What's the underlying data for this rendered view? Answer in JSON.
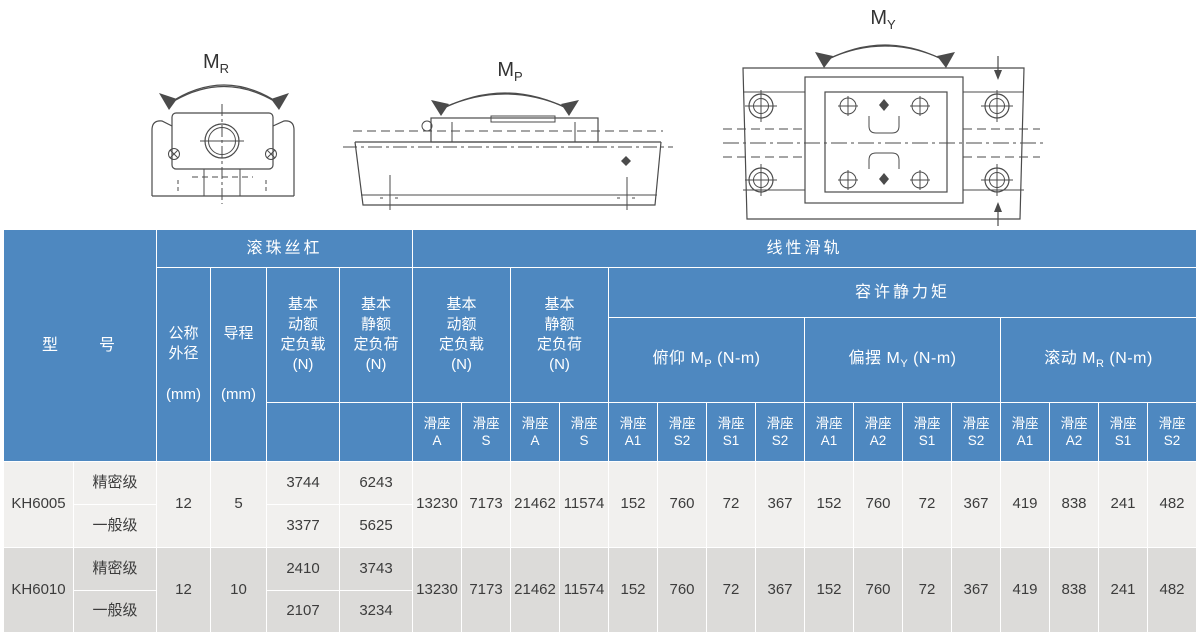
{
  "diagrams": {
    "roll": {
      "label": "M",
      "sub": "R"
    },
    "pitch": {
      "label": "M",
      "sub": "P"
    },
    "yaw": {
      "label": "M",
      "sub": "Y"
    }
  },
  "colors": {
    "header_bg": "#4e88c0",
    "row_light": "#f1f0ee",
    "row_dark": "#dcdbd9"
  },
  "table": {
    "header": {
      "model": "型　　号",
      "ball_screw": "滚珠丝杠",
      "linear_guide": "线性滑轨",
      "nominal_od": "公称\n外径\n\n(mm)",
      "lead": "导程\n\n\n(mm)",
      "screw_dyn": "基本\n动额\n定负载\n(N)",
      "screw_stat": "基本\n静额\n定负荷\n(N)",
      "guide_dyn": "基本\n动额\n定负载\n(N)",
      "guide_stat": "基本\n静额\n定负荷\n(N)",
      "moment": "容许静力矩",
      "pitch": {
        "prefix": "俯仰 M",
        "sub": "P",
        "suffix": " (N-m)"
      },
      "yaw": {
        "prefix": "偏摆 M",
        "sub": "Y",
        "suffix": " (N-m)"
      },
      "roll": {
        "prefix": "滚动 M",
        "sub": "R",
        "suffix": " (N-m)"
      }
    },
    "sliders": [
      "滑座\nA",
      "滑座\nS",
      "滑座\nA",
      "滑座\nS",
      "滑座\nA1",
      "滑座\nS2",
      "滑座\nS1",
      "滑座\nS2",
      "滑座\nA1",
      "滑座\nA2",
      "滑座\nS1",
      "滑座\nS2",
      "滑座\nA1",
      "滑座\nA2",
      "滑座\nS1",
      "滑座\nS2"
    ],
    "rows": [
      {
        "model": "KH6005",
        "od": "12",
        "lead": "5",
        "grades": [
          {
            "name": "精密级",
            "screw_dyn": "3744",
            "screw_stat": "6243"
          },
          {
            "name": "一般级",
            "screw_dyn": "3377",
            "screw_stat": "5625"
          }
        ],
        "values": [
          "13230",
          "7173",
          "21462",
          "11574",
          "152",
          "760",
          "72",
          "367",
          "152",
          "760",
          "72",
          "367",
          "419",
          "838",
          "241",
          "482"
        ]
      },
      {
        "model": "KH6010",
        "od": "12",
        "lead": "10",
        "grades": [
          {
            "name": "精密级",
            "screw_dyn": "2410",
            "screw_stat": "3743"
          },
          {
            "name": "一般级",
            "screw_dyn": "2107",
            "screw_stat": "3234"
          }
        ],
        "values": [
          "13230",
          "7173",
          "21462",
          "11574",
          "152",
          "760",
          "72",
          "367",
          "152",
          "760",
          "72",
          "367",
          "419",
          "838",
          "241",
          "482"
        ]
      }
    ]
  }
}
